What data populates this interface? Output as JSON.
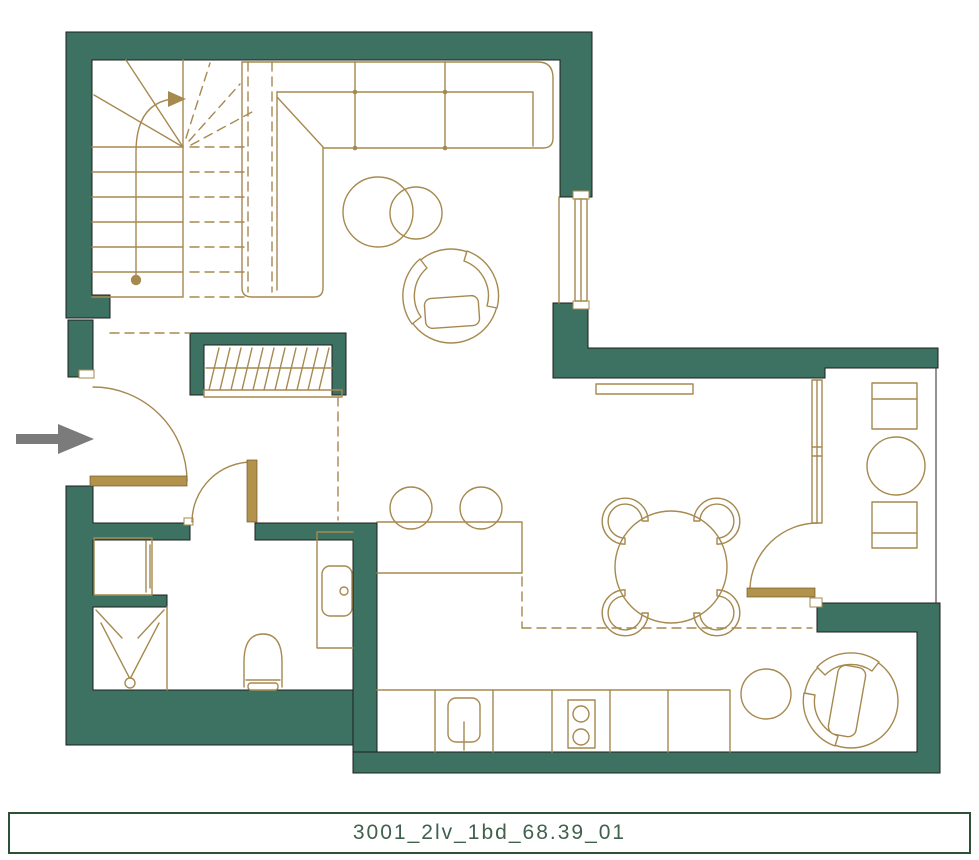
{
  "plan": {
    "label": "3001_2lv_1bd_68.39_01"
  },
  "colors": {
    "wall": "#3D7263",
    "wall-outline": "#1d1d1b",
    "line": "#A6894F",
    "door-leaf": "#B3924B",
    "arrow": "#7B7B7B",
    "label-text": "#41604D",
    "label-border": "#2C5134",
    "bg": "#FFFFFF"
  },
  "symbols": [
    "entrance-arrow",
    "staircase",
    "stair-direction-arrow",
    "sectional-sofa",
    "coffee-tables",
    "round-armchair",
    "wardrobe",
    "entry-door",
    "bathroom-door",
    "washing-machine",
    "shower",
    "toilet",
    "vanity-sink",
    "breakfast-bar",
    "bar-stools",
    "dining-table",
    "dining-chairs",
    "kitchen-counter",
    "kitchen-sink",
    "hob",
    "window",
    "glazed-partition",
    "balcony-door",
    "balcony-chairs",
    "balcony-table",
    "side-table",
    "lounge-armchair",
    "radiator"
  ]
}
